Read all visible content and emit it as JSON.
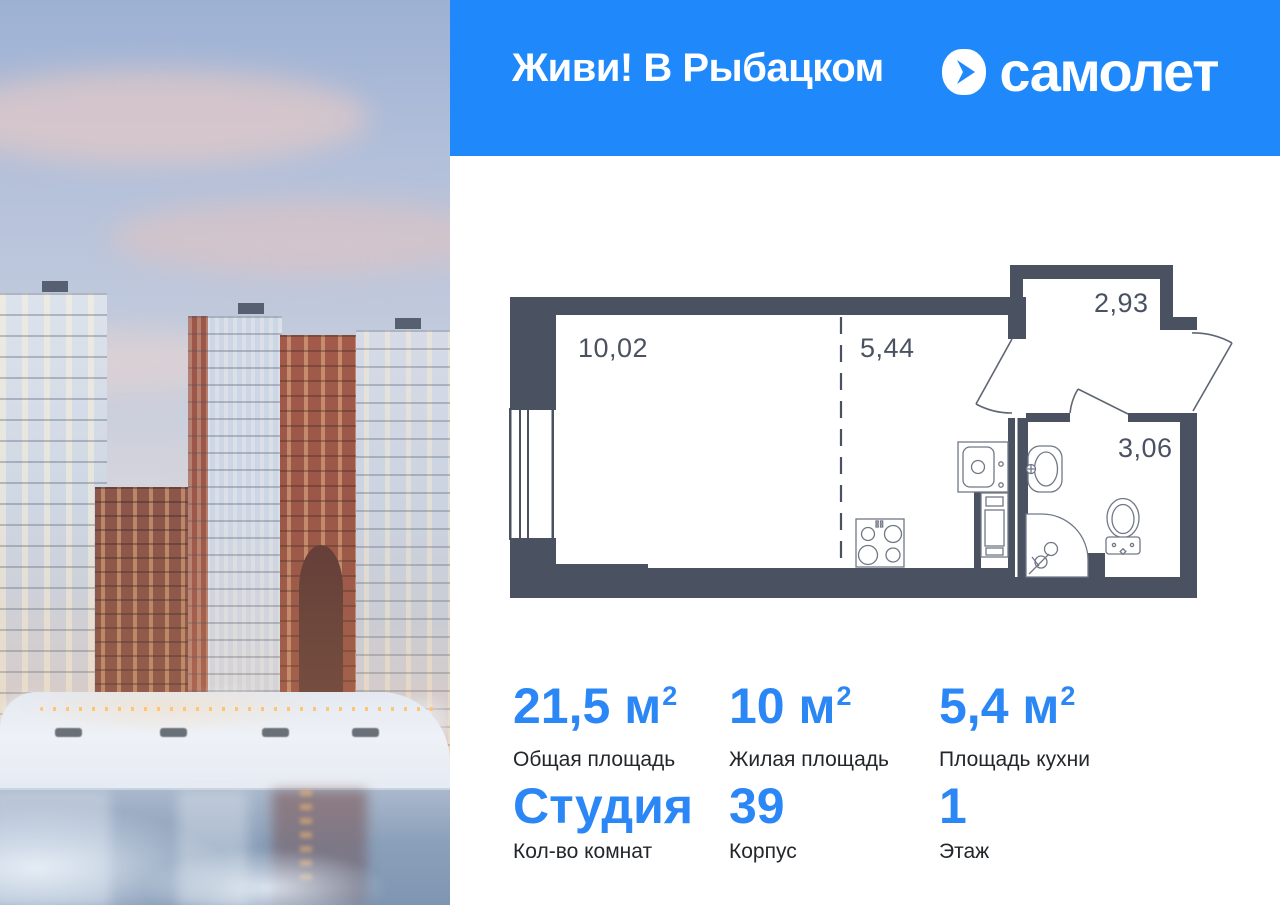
{
  "header": {
    "project_title": "Живи! В Рыбацком",
    "brand_name": "самолет",
    "logo_icon": "samolet-arrow-icon"
  },
  "floor_plan": {
    "living_area": "10,02",
    "kitchen_area": "5,44",
    "balcony_area": "2,93",
    "bathroom_area": "3,06"
  },
  "stats": {
    "total_area": {
      "value": "21,5 м",
      "sup": "2",
      "label": "Общая площадь"
    },
    "living_area": {
      "value": "10 м",
      "sup": "2",
      "label": "Жилая площадь"
    },
    "kitchen_area": {
      "value": "5,4 м",
      "sup": "2",
      "label": "Площадь кухни"
    },
    "rooms": {
      "value": "Студия",
      "label": "Кол-во комнат"
    },
    "building": {
      "value": "39",
      "label": "Корпус"
    },
    "floor": {
      "value": "1",
      "label": "Этаж"
    }
  },
  "colors": {
    "header_bg": "#1f88fa",
    "accent_blue": "#2a87f5",
    "plan_wall": "#4a5262",
    "label_text": "#23262b"
  }
}
